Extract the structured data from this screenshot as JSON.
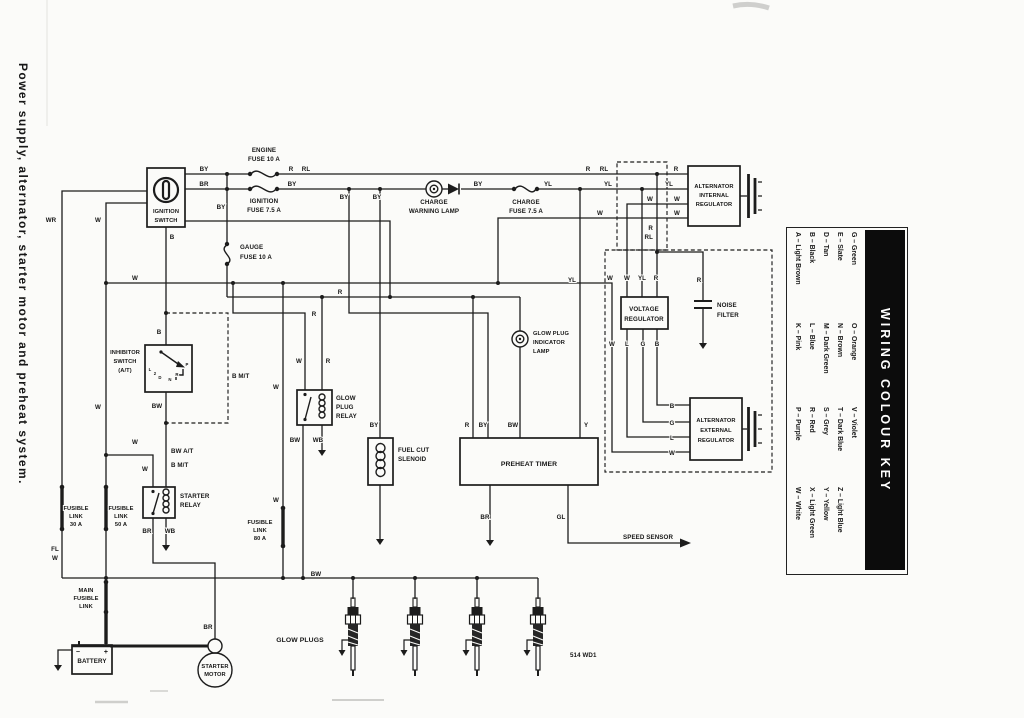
{
  "sidebar": {
    "caption": "Power supply, alternator, starter motor and preheat system."
  },
  "colour_key": {
    "title": "WIRING COLOUR KEY",
    "columns": [
      [
        "A – Light Brown",
        "K – Pink",
        "P – Purple",
        "W – White"
      ],
      [
        "B – Black",
        "L – Blue",
        "R – Red",
        "X – Light Green"
      ],
      [
        "D – Tan",
        "M – Dark Green",
        "S – Grey",
        "Y – Yellow"
      ],
      [
        "E – Slate",
        "N – Brown",
        "T – Dark Blue",
        "Z – Light Blue"
      ],
      [
        "G – Green",
        "O – Orange",
        "V – Violet",
        ""
      ]
    ]
  },
  "wires": {
    "W": "W",
    "WR": "WR",
    "BY": "BY",
    "BR": "BR",
    "R": "R",
    "RL": "RL",
    "YL": "YL",
    "Y": "Y",
    "B": "B",
    "BW": "BW",
    "WB": "WB",
    "GL": "GL",
    "FL": "FL",
    "G": "G",
    "L": "L",
    "B_MT": "B M/T",
    "BW_AT": "BW A/T"
  },
  "components": {
    "ignition_switch": [
      "IGNITION",
      "SWITCH"
    ],
    "engine_fuse": [
      "ENGINE",
      "FUSE 10 A"
    ],
    "ignition_fuse": [
      "IGNITION",
      "FUSE 7.5 A"
    ],
    "gauge_fuse": [
      "GAUGE",
      "FUSE 10 A"
    ],
    "charge_warning_lamp": [
      "CHARGE",
      "WARNING LAMP"
    ],
    "charge_fuse": [
      "CHARGE",
      "FUSE 7.5 A"
    ],
    "alternator_internal_regulator": [
      "ALTERNATOR",
      "INTERNAL",
      "REGULATOR"
    ],
    "voltage_regulator": [
      "VOLTAGE",
      "REGULATOR"
    ],
    "noise_filter": [
      "NOISE",
      "FILTER"
    ],
    "alternator_external_regulator": [
      "ALTERNATOR",
      "EXTERNAL",
      "REGULATOR"
    ],
    "glow_plug_indicator_lamp": [
      "GLOW PLUG",
      "INDICATOR",
      "LAMP"
    ],
    "glow_plug_relay": [
      "GLOW",
      "PLUG",
      "RELAY"
    ],
    "fuel_cut_solenoid": [
      "FUEL CUT",
      "SLENOID"
    ],
    "preheat_timer": [
      "PREHEAT TIMER"
    ],
    "inhibitor_switch": [
      "INHIBITOR",
      "SWITCH",
      "(A/T)"
    ],
    "starter_relay": [
      "STARTER",
      "RELAY"
    ],
    "fusible_link_30": [
      "FUSIBLE",
      "LINK",
      "30 A"
    ],
    "fusible_link_50": [
      "FUSIBLE",
      "LINK",
      "50 A"
    ],
    "fusible_link_80": [
      "FUSIBLE",
      "LINK",
      "80 A"
    ],
    "main_fusible_link": [
      "MAIN",
      "FUSIBLE",
      "LINK"
    ],
    "battery": [
      "BATTERY"
    ],
    "starter_motor": [
      "STARTER",
      "MOTOR"
    ],
    "glow_plugs": [
      "GLOW PLUGS"
    ],
    "speed_sensor": [
      "SPEED SENSOR"
    ]
  },
  "gear_positions": {
    "p": "P",
    "r": "R",
    "n": "N",
    "d": "D",
    "two": "2",
    "l": "L"
  },
  "battery_polarity": {
    "plus": "+",
    "minus": "−"
  },
  "diagram_code": "514 WD1"
}
